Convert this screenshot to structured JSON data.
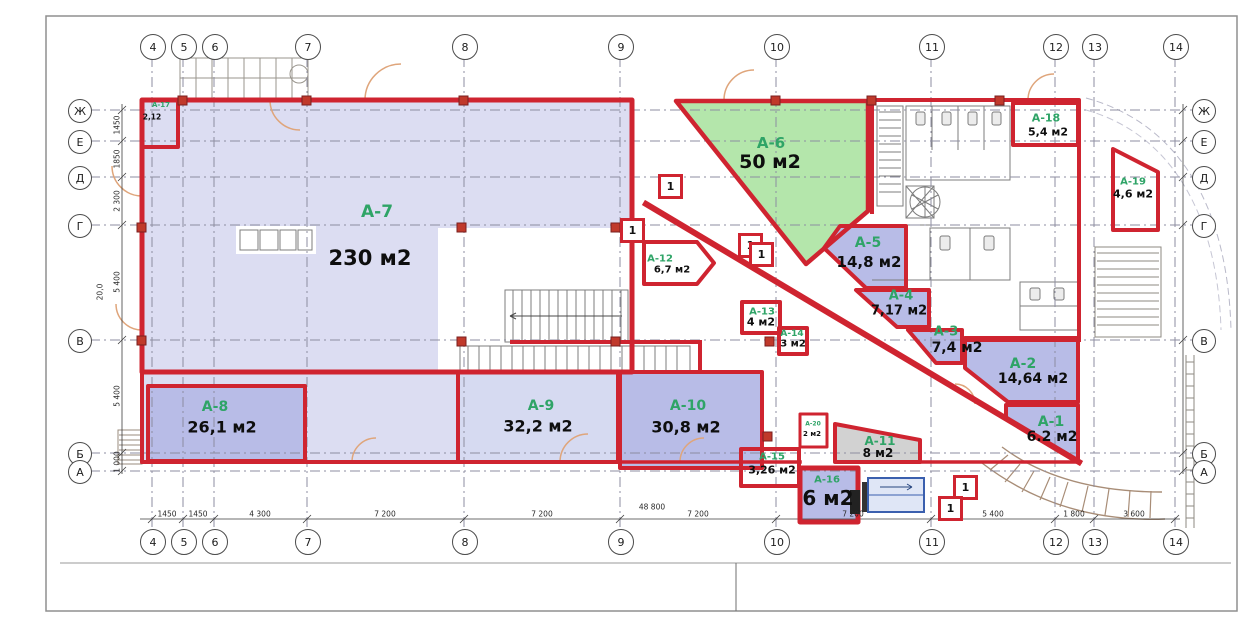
{
  "plan": {
    "axes_top": [
      "4",
      "5",
      "6",
      "7",
      "8",
      "9",
      "10",
      "11",
      "12",
      "13",
      "14"
    ],
    "axes_bottom": [
      "4",
      "5",
      "6",
      "7",
      "8",
      "9",
      "10",
      "11",
      "12",
      "13",
      "14"
    ],
    "axes_left": [
      "Ж",
      "Е",
      "Д",
      "Г",
      "В",
      "Б",
      "А"
    ],
    "axes_right": [
      "Ж",
      "Е",
      "Д",
      "Г",
      "В",
      "Б",
      "А"
    ],
    "dims_bottom": [
      "1450",
      "1450",
      "4 300",
      "7 200",
      "7 200",
      "7 200",
      "7 200",
      "5 400",
      "1 800",
      "3 600"
    ],
    "dim_total_bottom": "48 800",
    "dims_left": [
      "1450",
      "1850",
      "2 300",
      "5 400",
      "5 400",
      "1 000"
    ],
    "dim_total_left": "20,0",
    "rooms": [
      {
        "code": "A-1",
        "area": "6.2 м2"
      },
      {
        "code": "A-2",
        "area": "14,64 м2"
      },
      {
        "code": "A-3",
        "area": "7,4 м2"
      },
      {
        "code": "A-4",
        "area": "7,17 м2"
      },
      {
        "code": "A-5",
        "area": "14,8 м2"
      },
      {
        "code": "A-6",
        "area": "50 м2"
      },
      {
        "code": "A-7",
        "area": "230 м2"
      },
      {
        "code": "A-8",
        "area": "26,1 м2"
      },
      {
        "code": "A-9",
        "area": "32,2 м2"
      },
      {
        "code": "A-10",
        "area": "30,8 м2"
      },
      {
        "code": "A-11",
        "area": "8 м2"
      },
      {
        "code": "A-12",
        "area": "6,7 м2"
      },
      {
        "code": "A-13",
        "area": "4 м2"
      },
      {
        "code": "A-14",
        "area": "3 м2"
      },
      {
        "code": "A-15",
        "area": "3,26 м2"
      },
      {
        "code": "A-16",
        "area": "6 м2"
      },
      {
        "code": "A-17",
        "area": "2,12"
      },
      {
        "code": "A-18",
        "area": "5,4 м2"
      },
      {
        "code": "A-19",
        "area": "4,6 м2"
      },
      {
        "code": "A-20",
        "area": "2 м2"
      }
    ],
    "markers": [
      "1",
      "1",
      "1",
      "1",
      "1",
      "1"
    ],
    "colors": {
      "wall_red": "#cf2430",
      "room_dark": "#b8bce7",
      "room_light": "#dcddf2",
      "room_green": "#b4e6ab",
      "room_gray": "#d2d2d2",
      "label_green": "#2fa467"
    }
  }
}
